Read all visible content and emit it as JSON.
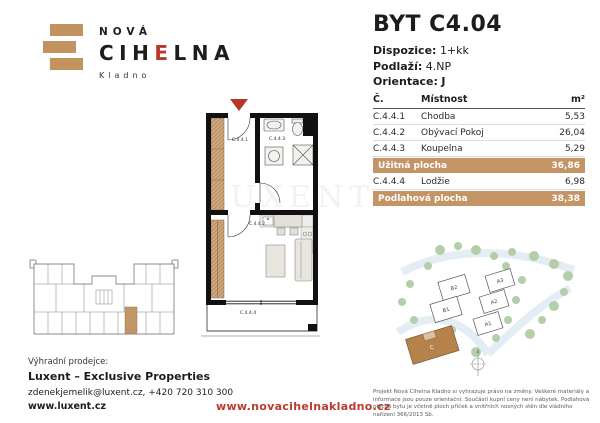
{
  "colors": {
    "accent_tan": "#c49465",
    "accent_red": "#b8392c",
    "wall_black": "#111111",
    "tree_green": "#b3cfa9",
    "building_c_brown": "#b5824c"
  },
  "brand": {
    "top": "NOVÁ",
    "name_pre": "CIH",
    "name_e": "E",
    "name_post": "LNA",
    "city": "Kladno",
    "brick_icon": "three-brick-logo"
  },
  "unit": {
    "title": "BYT C4.04",
    "specs": {
      "d_label": "Dispozice:",
      "d_value": "1+kk",
      "p_label": "Podlaží:",
      "p_value": "4.NP",
      "o_label": "Orientace:",
      "o_value": "J"
    }
  },
  "table": {
    "headers": {
      "no": "Č.",
      "room": "Místnost",
      "area": "m²"
    },
    "rows": [
      {
        "no": "C.4.4.1",
        "room": "Chodba",
        "area": "5,53"
      },
      {
        "no": "C.4.4.2",
        "room": "Obývací Pokoj",
        "area": "26,04"
      },
      {
        "no": "C.4.4.3",
        "room": "Koupelna",
        "area": "5,29"
      }
    ],
    "usable": {
      "label": "Užitná plocha",
      "area": "36,86"
    },
    "extra_row": {
      "no": "C.4.4.4",
      "room": "Lodžie",
      "area": "6,98"
    },
    "floor": {
      "label": "Podlahová plocha",
      "area": "38,38"
    }
  },
  "plan": {
    "rooms": {
      "r1": "C.4.4.1",
      "r2": "C.4.4.2",
      "r3": "C.4.4.3",
      "r4": "C.4.4.4"
    },
    "entrance_marker": "red-arrow-down"
  },
  "site": {
    "a1": "A1",
    "a2": "A2",
    "a3": "A3",
    "b1": "B1",
    "b2": "B2",
    "c": "C"
  },
  "footer": {
    "seller_label": "Výhradní prodejce:",
    "seller_name": "Luxent – Exclusive Properties",
    "seller_contact": "zdenekjemelik@luxent.cz, +420 720 310 300",
    "seller_web": "www.luxent.cz",
    "project_web": "www.novacihelnakladno.cz",
    "disclaimer": "Projekt Nová Cihelna Kladno si vyhrazuje právo na změny. Veškeré materiály a informace jsou pouze orientační. Součástí kupní ceny není nábytek. Podlahová plocha bytu je včetně ploch příček a vnitřních nosných stěn dle vládního nařízení 366/2013 Sb."
  }
}
